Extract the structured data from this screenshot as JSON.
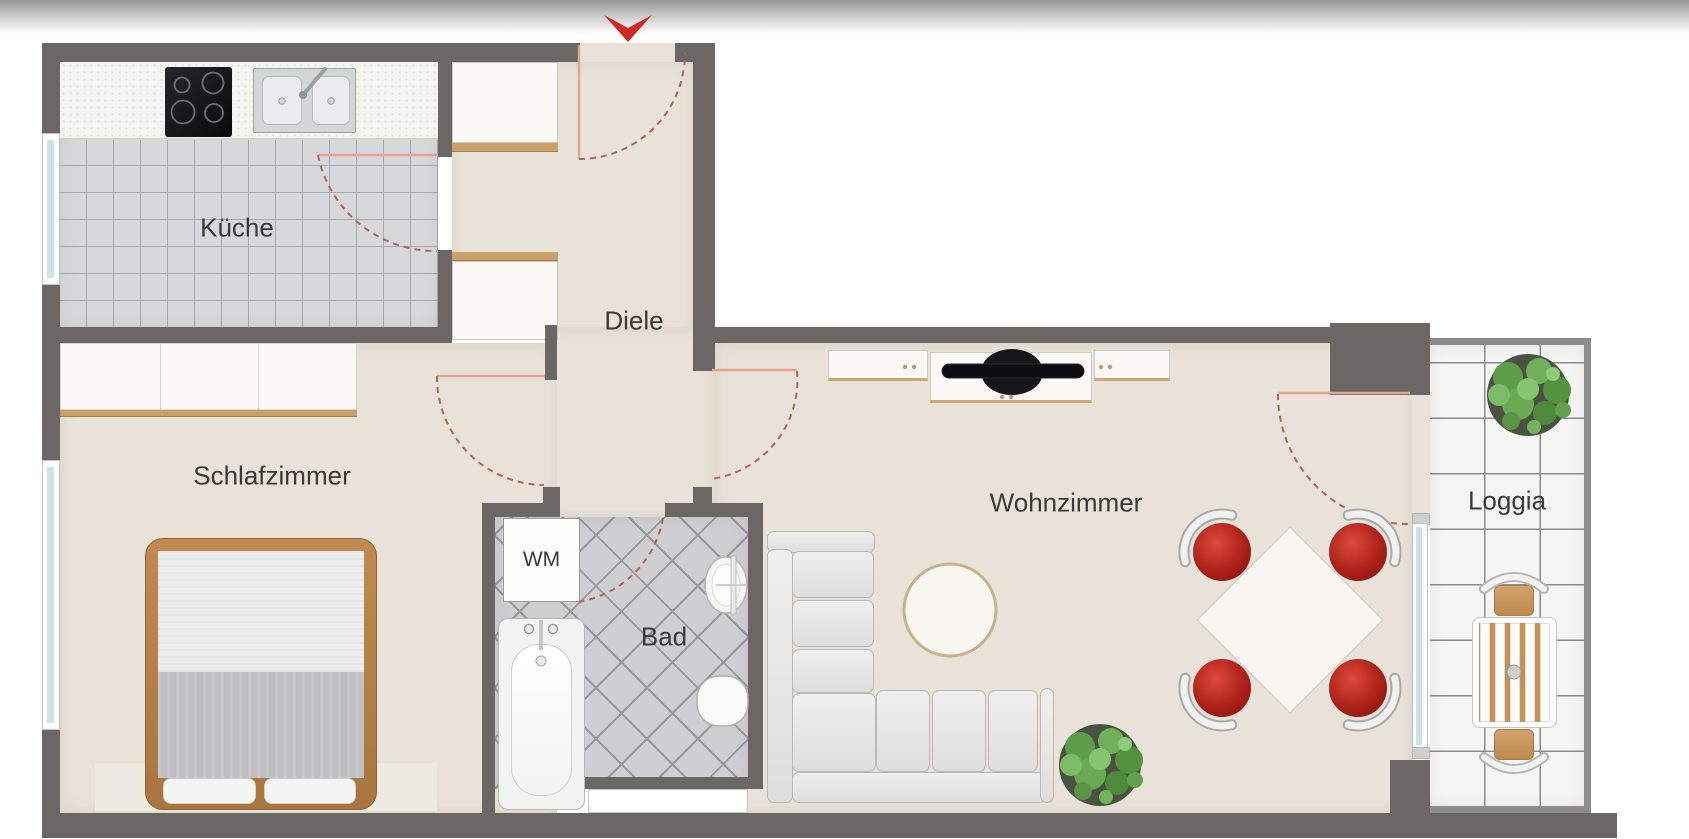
{
  "title": "Apartment floor plan",
  "labels": {
    "kueche": "Küche",
    "diele": "Diele",
    "schlafzimmer": "Schlafzimmer",
    "bad": "Bad",
    "wm": "WM",
    "wohnzimmer": "Wohnzimmer",
    "loggia": "Loggia"
  },
  "icons": {
    "entrance_arrow_icon": "red arrow marking the apartment entrance door"
  },
  "furniture": [
    "stove",
    "kitchen-sink",
    "hall-cabinets",
    "wardrobe",
    "double-bed",
    "washing-machine",
    "bathtub",
    "wash-basin",
    "toilet",
    "corner-sofa",
    "coffee-table",
    "tv-sideboard",
    "tv",
    "dining-table",
    "dining-chairs",
    "plant",
    "loggia-table",
    "loggia-chairs"
  ],
  "colors": {
    "wall": "#6b6765",
    "wall_thin": "#8d8d8b",
    "floor": "#e8e2d8",
    "kitchen_tile": "#d7d8da",
    "kitchen_tile_line": "#a6aab0",
    "bath_tile": "#cfcfd1",
    "bath_tile_line": "#96989c",
    "loggia_tile": "#f5f5f3",
    "loggia_tile_line": "#8a8c8f",
    "counter": "#f3f3ef",
    "wood_trim": "#c9a06a",
    "bed_wood": "#b9854e",
    "entrance_red": "#cf2a22",
    "chair_red": "#b02318",
    "door_leaf": "#e7a295",
    "door_arc": "#b5645a",
    "window_glass": "#cde3e8",
    "furniture_white": "#faf9f6",
    "furniture_border": "#c9c6c0",
    "sofa_gray": "#e8e8e8",
    "sofa_border": "#b9b9b9",
    "label_text": "#3a3a3a"
  }
}
